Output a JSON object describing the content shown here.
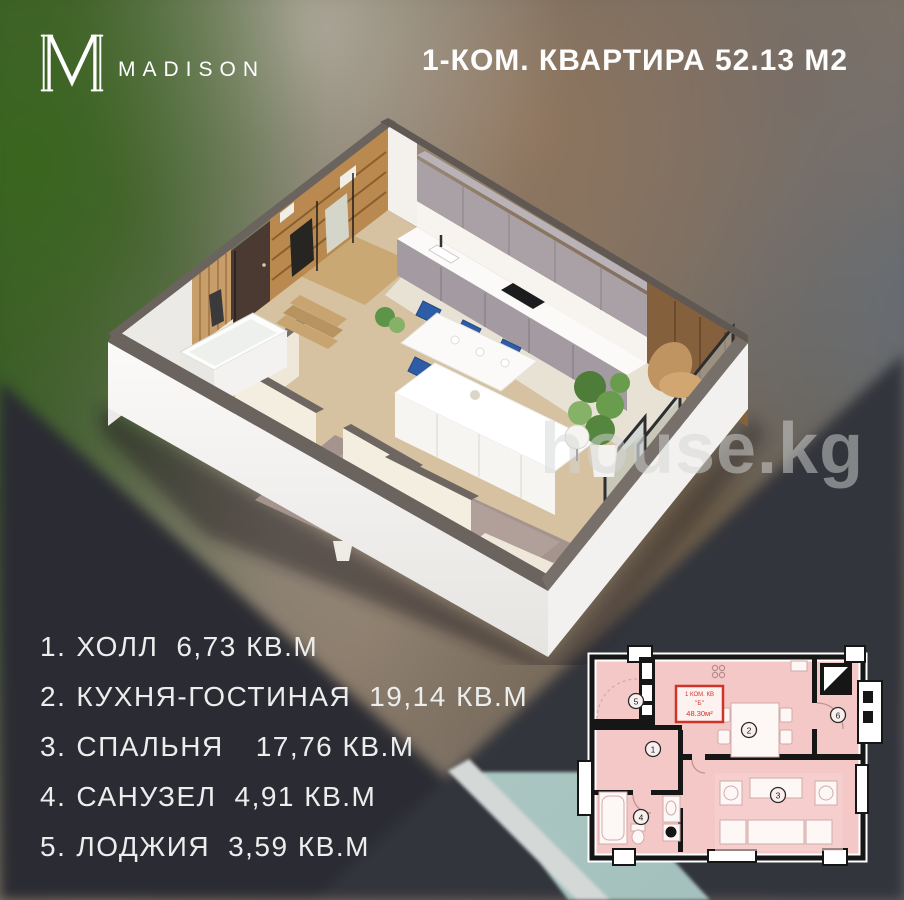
{
  "brand": {
    "name": "MADISON",
    "monogram": "M"
  },
  "header": {
    "title": "1-КОМ. КВАРТИРА 52.13 М2"
  },
  "watermark": "house.kg",
  "room_list": {
    "items": [
      {
        "num": "1.",
        "name": "ХОЛЛ",
        "area": "6,73 КВ.М"
      },
      {
        "num": "2.",
        "name": "КУХНЯ-ГОСТИНАЯ",
        "area": "19,14 КВ.М"
      },
      {
        "num": "3.",
        "name": "СПАЛЬНЯ",
        "area": "17,76 КВ.М"
      },
      {
        "num": "4.",
        "name": "САНУЗЕЛ",
        "area": "4,91 КВ.М"
      },
      {
        "num": "5.",
        "name": "ЛОДЖИЯ",
        "area": "3,59 КВ.М"
      }
    ]
  },
  "floor_plan": {
    "unit_label": {
      "line1": "1 КОМ. КВ",
      "line2": "\"Б\"",
      "line3": "48.30м²"
    },
    "room_numbers": [
      "1",
      "2",
      "3",
      "4",
      "5",
      "6"
    ]
  },
  "colors": {
    "accent_red": "#cf3429",
    "plan_room_fill": "#f3c8c7",
    "dark_panel": "#2b2c33",
    "teal_stripe": "#b9d2cd"
  }
}
